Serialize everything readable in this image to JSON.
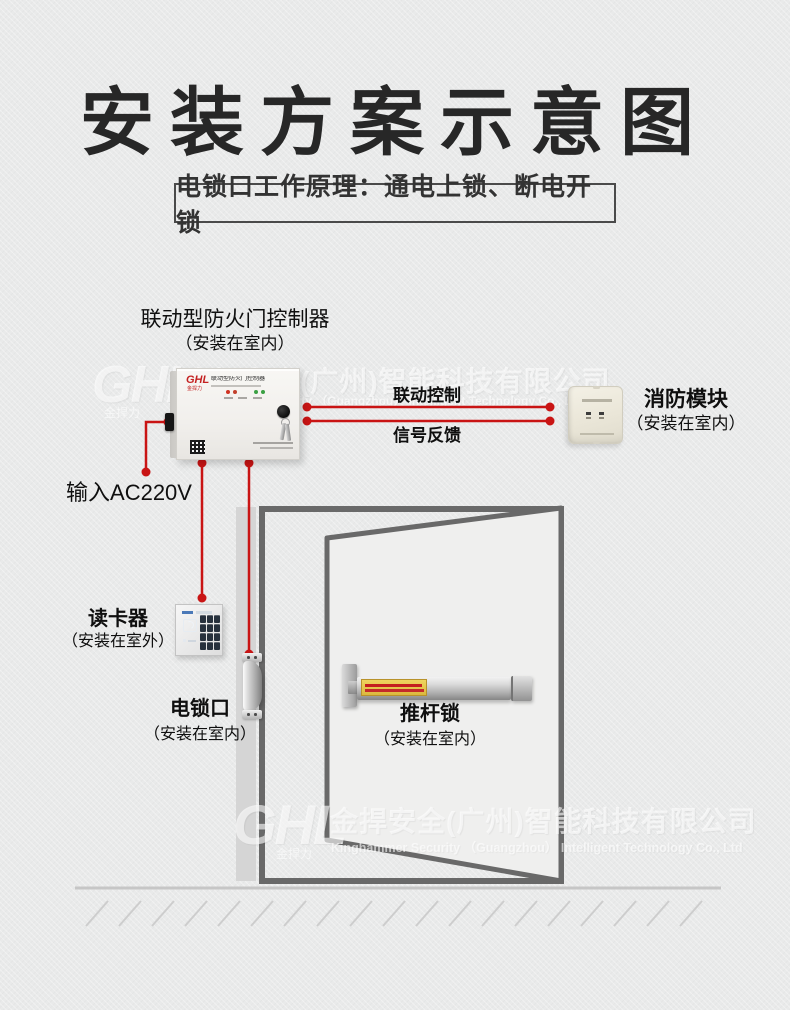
{
  "title": "安装方案示意图",
  "principle": "电锁口工作原理：通电上锁、断电开锁",
  "watermark": {
    "logo": "GHL",
    "logo_sub": "金捍力",
    "cn": "金捍安全(广州)智能科技有限公司",
    "en": "Kinghammer Security （Guangzhou） Intelligent Technology Co., Ltd"
  },
  "controller": {
    "label": "联动型防火门控制器",
    "sublabel": "（安装在室内）",
    "brand": "GHL",
    "brand_sub": "金捍力",
    "panel_title": "联动型防火门控制器"
  },
  "connections": {
    "power": "输入AC220V",
    "control": "联动控制",
    "feedback": "信号反馈"
  },
  "fire_module": {
    "label": "消防模块",
    "sublabel": "（安装在室内）"
  },
  "card_reader": {
    "label": "读卡器",
    "sublabel": "（安装在室外）"
  },
  "electric_lock": {
    "label": "电锁口",
    "sublabel": "（安装在室内）"
  },
  "push_bar": {
    "label": "推杆锁",
    "sublabel": "（安装在室内）"
  },
  "colors": {
    "accent_red": "#c91414",
    "frame_gray": "#696969",
    "wall_gray": "#d5d5d5",
    "background": "#e9eaea",
    "led_red": "#d03322",
    "led_green": "#3aa043"
  }
}
